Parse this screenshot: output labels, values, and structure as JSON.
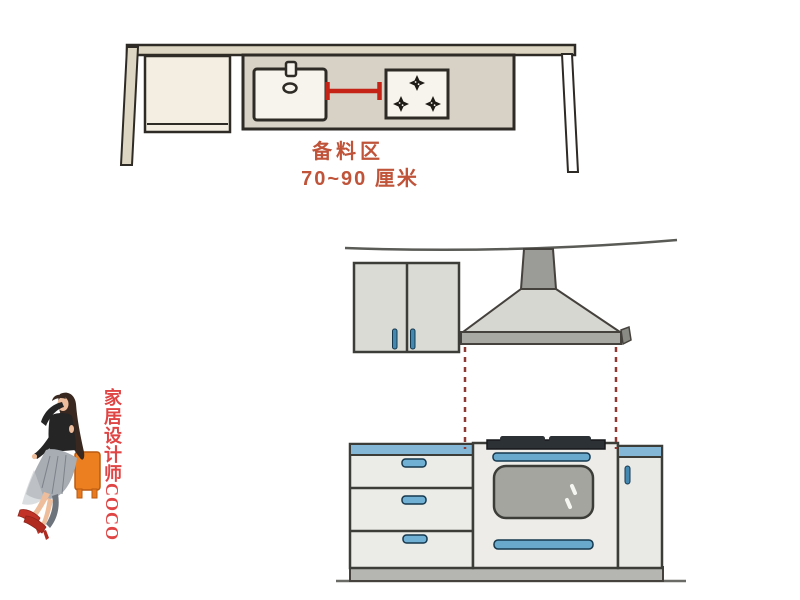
{
  "page": {
    "width": 800,
    "height": 600,
    "background": "#ffffff"
  },
  "plan_view": {
    "description": "top view of kitchen counter with sink and cooktop",
    "zone_label": "备料区",
    "distance_label": "70~90 厘米",
    "burner_count": 3
  },
  "elevation_view": {
    "description": "front view of kitchen run with wall cabinet, range hood, drawers, oven and cabinet",
    "drawer_count": 3
  },
  "watermark": {
    "text": "家居设计师COCO"
  },
  "colors": {
    "measure_red": "#c52315",
    "label_red": "#c0543a",
    "watermark_red": "#e04545",
    "dash_maroon": "#8e3a34",
    "counter_blue": "#84b7d6",
    "handle_blue": "#6fb0d4",
    "handle_blue_dark": "#4288b0",
    "wall_beige": "#ddd6c2",
    "counter_beige": "#d7d2c5",
    "cabinet_cream": "#f3eee1",
    "sink_white": "#f7f4ed",
    "hood_gray": "#d7d7d2",
    "chimney_gray": "#9b9b97",
    "lip_gray": "#a9a9a4",
    "cab_light": "#ebebe7",
    "plinth_gray": "#b5b5b1",
    "window_gray": "#a5a5a0",
    "cooktop_dark": "#2c3136",
    "stool_orange": "#ec7f1f",
    "outline_dark": "#2e2a25",
    "outline_elev": "#3c3c38"
  }
}
